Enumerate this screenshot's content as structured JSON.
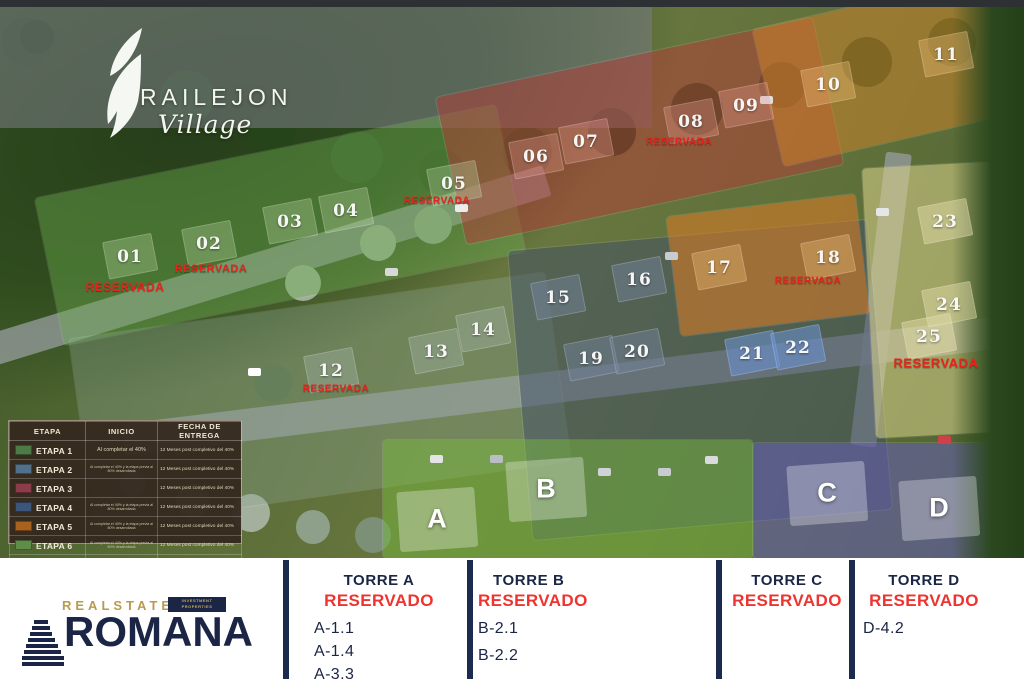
{
  "logo": {
    "title": "RAILEJON",
    "subtitle": "Village"
  },
  "legend": {
    "headers": [
      "ETAPA",
      "INICIO",
      "FECHA DE ENTREGA"
    ],
    "rows": [
      {
        "label": "ETAPA 1",
        "color": "#4d7a45",
        "inicio": "Al completar el 40%",
        "inicio_tiny": false,
        "entrega": "12 Meses post completivo del 40%",
        "entrega_big": false
      },
      {
        "label": "ETAPA 2",
        "color": "#51708c",
        "inicio": "Al completar el 40% y la etapa previa al 80% desarrollada",
        "inicio_tiny": true,
        "entrega": "12 Meses post completivo del 40%",
        "entrega_big": false
      },
      {
        "label": "ETAPA 3",
        "color": "#8c3d4a",
        "inicio": "",
        "inicio_tiny": true,
        "entrega": "12 Meses post completivo del 40%",
        "entrega_big": false
      },
      {
        "label": "ETAPA 4",
        "color": "#3c557a",
        "inicio": "Al completar el 40% y la etapa previa al 80% desarrollada",
        "inicio_tiny": true,
        "entrega": "12 Meses post completivo del 40%",
        "entrega_big": false
      },
      {
        "label": "ETAPA 5",
        "color": "#a8611f",
        "inicio": "Al completar el 40% y la etapa previa al 80% desarrollada",
        "inicio_tiny": true,
        "entrega": "12 Meses post completivo del 40%",
        "entrega_big": false
      },
      {
        "label": "ETAPA 6",
        "color": "#5f8c49",
        "inicio": "Al completar el 40% y la etapa previa al 80% desarrollada",
        "inicio_tiny": true,
        "entrega": "12 Meses post completivo del 40%",
        "entrega_big": false
      },
      {
        "label": "ETAPA 7",
        "color": "#c9ba88",
        "inicio": "Al completar el 40% y la etapa previa al 80% desarrollada",
        "inicio_tiny": true,
        "entrega": "3er Trimestre 2029",
        "entrega_big": true
      },
      {
        "label": "ETAPA 8",
        "color": "#4c4f93",
        "inicio": "Al completar el 40% y la etapa previa al 80% desarrollada",
        "inicio_tiny": true,
        "entrega": "2do Trimestre 2030",
        "entrega_big": true
      }
    ]
  },
  "map": {
    "lots": [
      {
        "label": "01",
        "x": 130,
        "y": 257,
        "zone": "g"
      },
      {
        "label": "02",
        "x": 209,
        "y": 244,
        "zone": "g"
      },
      {
        "label": "03",
        "x": 290,
        "y": 222,
        "zone": "g"
      },
      {
        "label": "04",
        "x": 346,
        "y": 211,
        "zone": "g"
      },
      {
        "label": "05",
        "x": 454,
        "y": 184,
        "zone": "g"
      },
      {
        "label": "06",
        "x": 536,
        "y": 157,
        "zone": "r"
      },
      {
        "label": "07",
        "x": 586,
        "y": 142,
        "zone": "r"
      },
      {
        "label": "08",
        "x": 691,
        "y": 122,
        "zone": "r"
      },
      {
        "label": "09",
        "x": 746,
        "y": 106,
        "zone": "r"
      },
      {
        "label": "10",
        "x": 828,
        "y": 85,
        "zone": "o"
      },
      {
        "label": "11",
        "x": 946,
        "y": 55,
        "zone": "o"
      },
      {
        "label": "12",
        "x": 331,
        "y": 371,
        "zone": "gr"
      },
      {
        "label": "13",
        "x": 436,
        "y": 352,
        "zone": "gr"
      },
      {
        "label": "14",
        "x": 483,
        "y": 330,
        "zone": "gr"
      },
      {
        "label": "15",
        "x": 558,
        "y": 298,
        "zone": "bl"
      },
      {
        "label": "16",
        "x": 639,
        "y": 280,
        "zone": "bl"
      },
      {
        "label": "17",
        "x": 719,
        "y": 268,
        "zone": "o"
      },
      {
        "label": "18",
        "x": 828,
        "y": 258,
        "zone": "o"
      },
      {
        "label": "19",
        "x": 591,
        "y": 359,
        "zone": "bl"
      },
      {
        "label": "20",
        "x": 637,
        "y": 352,
        "zone": "bl"
      },
      {
        "label": "21",
        "x": 752,
        "y": 354,
        "zone": "pool"
      },
      {
        "label": "22",
        "x": 798,
        "y": 348,
        "zone": "pool"
      },
      {
        "label": "23",
        "x": 945,
        "y": 222,
        "zone": "t"
      },
      {
        "label": "24",
        "x": 949,
        "y": 305,
        "zone": "t"
      },
      {
        "label": "25",
        "x": 929,
        "y": 337,
        "zone": "t"
      }
    ],
    "reserved_labels": [
      {
        "text": "RESERVADA",
        "x": 125,
        "y": 287,
        "fs": 12
      },
      {
        "text": "RESERVADA",
        "x": 211,
        "y": 269,
        "fs": 11
      },
      {
        "text": "RESERVADA",
        "x": 437,
        "y": 201,
        "fs": 10
      },
      {
        "text": "RESERVADA",
        "x": 679,
        "y": 142,
        "fs": 10
      },
      {
        "text": "RESERVADA",
        "x": 336,
        "y": 389,
        "fs": 10
      },
      {
        "text": "RESERVADA",
        "x": 808,
        "y": 281,
        "fs": 10
      },
      {
        "text": "RESERVADA",
        "x": 936,
        "y": 363,
        "fs": 13
      }
    ],
    "building_letters": [
      {
        "label": "A",
        "x": 437,
        "y": 519
      },
      {
        "label": "B",
        "x": 546,
        "y": 489
      },
      {
        "label": "C",
        "x": 827,
        "y": 493
      },
      {
        "label": "D",
        "x": 939,
        "y": 508
      }
    ]
  },
  "footer": {
    "brand": {
      "realstate": "REALSTATE",
      "badge_line1": "INVESTMENT",
      "badge_line2": "PROPERTIES",
      "name": "ROMANA"
    },
    "towers": [
      {
        "name": "TORRE A",
        "status": "RESERVADO",
        "units": [
          "A-1.1",
          "A-1.4",
          "A-3.3"
        ]
      },
      {
        "name": "TORRE B",
        "status": "RESERVADO",
        "units": [
          "B-2.1",
          "B-2.2"
        ]
      },
      {
        "name": "TORRE C",
        "status": "RESERVADO",
        "units": []
      },
      {
        "name": "TORRE D",
        "status": "RESERVADO",
        "units": [
          "D-4.2"
        ]
      }
    ]
  },
  "colors": {
    "navy": "#1b2545",
    "red": "#ee3430",
    "gold": "#b99a4e",
    "reserved_red": "#e8231c"
  }
}
